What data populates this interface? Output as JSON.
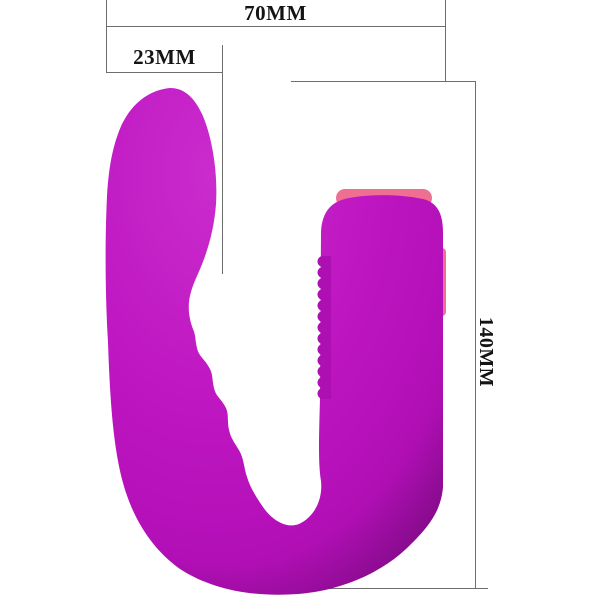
{
  "dimensions": {
    "width": {
      "label": "70MM"
    },
    "head_width": {
      "label": "23MM"
    },
    "height": {
      "label": "140MM"
    }
  },
  "colors": {
    "background": "#ffffff",
    "dimension_line": "#6e6e6e",
    "label_text": "#141414",
    "body_light": "#ca2ccd",
    "body": "#bf17c2",
    "body_mid": "#b30fb7",
    "body_shadow": "#8e0c93",
    "ribs": "#ae0fb2",
    "accent_pink": "#ee6f92"
  }
}
